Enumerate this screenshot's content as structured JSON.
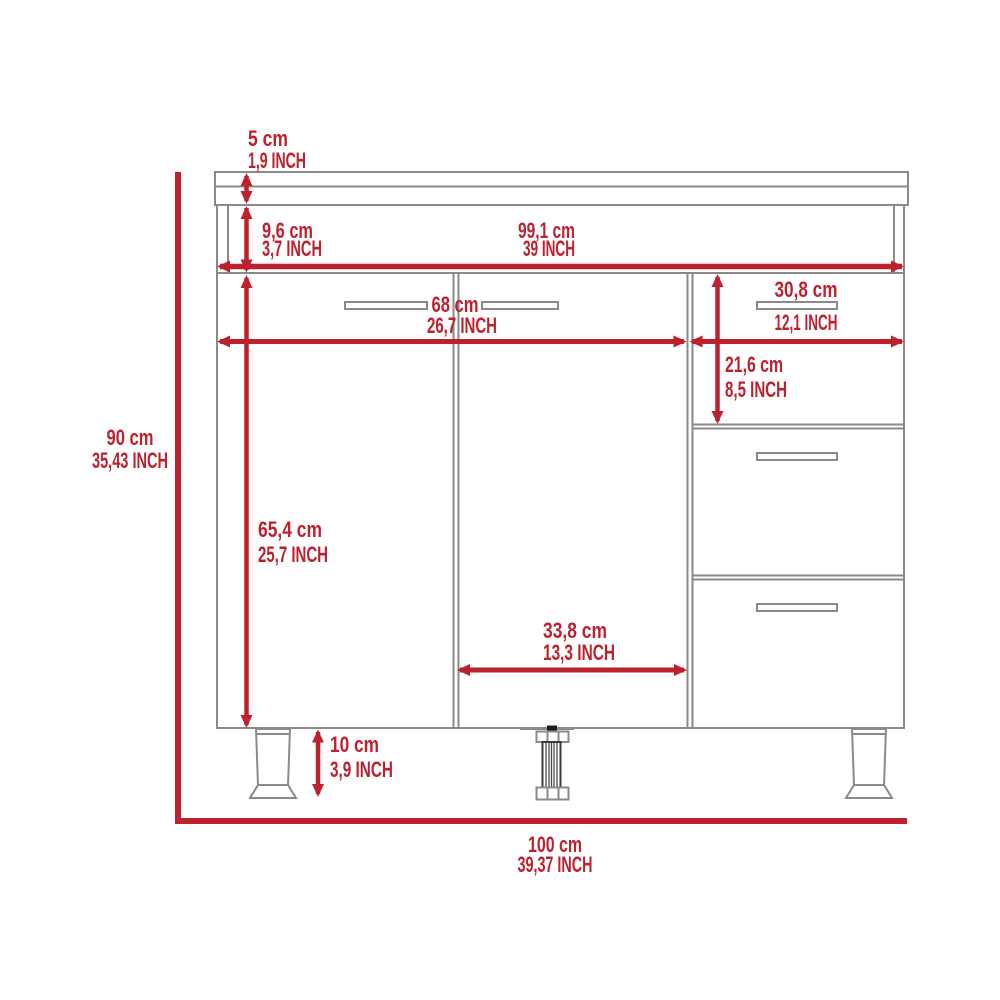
{
  "diagram": {
    "kind": "furniture-dimension-diagram",
    "subject": "base cabinet with countertop, two doors, three drawers and legs",
    "colors": {
      "dimension_red": "#be212e",
      "outline_gray": "#8a8a8a",
      "background": "#ffffff"
    },
    "dimensions": {
      "countertop_thickness": {
        "cm": "5 cm",
        "inch": "1,9 INCH"
      },
      "countertop_to_door_gap": {
        "cm": "9,6 cm",
        "inch": "3,7 INCH"
      },
      "interior_width": {
        "cm": "99,1 cm",
        "inch": "39 INCH"
      },
      "double_door_width": {
        "cm": "68 cm",
        "inch": "26,7 INCH"
      },
      "drawer_width": {
        "cm": "30,8 cm",
        "inch": "12,1 INCH"
      },
      "top_drawer_height": {
        "cm": "21,6 cm",
        "inch": "8,5 INCH"
      },
      "cabinet_height": {
        "cm": "90 cm",
        "inch": "35,43 INCH"
      },
      "door_height": {
        "cm": "65,4 cm",
        "inch": "25,7 INCH"
      },
      "single_door_width": {
        "cm": "33,8 cm",
        "inch": "13,3 INCH"
      },
      "leg_height": {
        "cm": "10 cm",
        "inch": "3,9 INCH"
      },
      "overall_width": {
        "cm": "100 cm",
        "inch": "39,37 INCH"
      }
    }
  }
}
